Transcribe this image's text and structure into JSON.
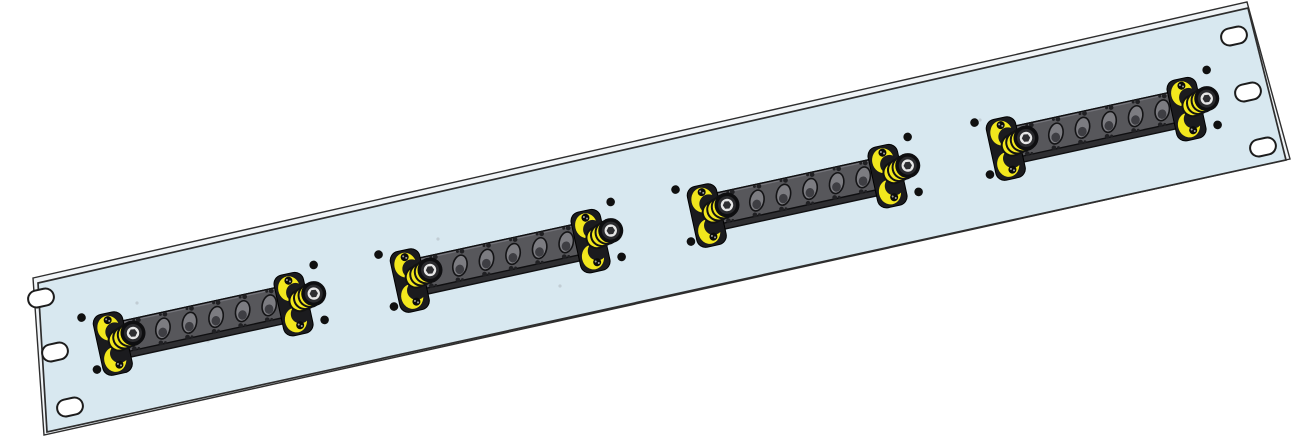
{
  "scene": {
    "width": 1298,
    "height": 441,
    "background": "#ffffff",
    "panel": {
      "description": "1U rack mount patch panel, isometric CAD render, rotated",
      "face_color": "#d8e8f0",
      "edge_color": "#2e2e2e",
      "thickness_color": "#f0f4f7",
      "corners": [
        [
          38,
          283
        ],
        [
          1248,
          8
        ],
        [
          1286,
          160
        ],
        [
          47,
          432
        ]
      ],
      "back_corners": [
        [
          33,
          278
        ],
        [
          1247,
          2
        ],
        [
          1290,
          159
        ],
        [
          44,
          435
        ]
      ]
    },
    "mounting_slots": {
      "fill": "#ffffff",
      "stroke": "#1c1c1c",
      "width": 26,
      "height": 17,
      "rx": 8.5,
      "angle": -12.8,
      "centers": [
        [
          41,
          298
        ],
        [
          55,
          352
        ],
        [
          70,
          407
        ],
        [
          1234,
          36
        ],
        [
          1248,
          92
        ],
        [
          1263,
          147
        ]
      ]
    },
    "modules": {
      "count": 4,
      "angle": -12.3,
      "anchors": [
        [
          133,
          333
        ],
        [
          430,
          270
        ],
        [
          727,
          205
        ],
        [
          1026,
          138
        ]
      ],
      "plate": {
        "x": -20,
        "y": -14,
        "w": 195,
        "h": 31,
        "bevel": 6,
        "face_color": "#57575b",
        "bevel_color": "#2e2e31",
        "stroke": "#0f0f11",
        "top_highlight": "#74747a"
      },
      "ports": {
        "count": 6,
        "start_x": 3,
        "spacing": 27.2,
        "cy": 2,
        "tilt": 24,
        "rx": 7,
        "ry": 10.5,
        "body_color": "#7c7c81",
        "inner_color": "#3e3e43",
        "stroke": "#141416",
        "screw_color": "#202023"
      },
      "holes": {
        "r": 4.3,
        "color": "#101010",
        "offsets": [
          [
            -47,
            -26
          ],
          [
            -43,
            28
          ],
          [
            191,
            -28
          ],
          [
            190,
            28
          ]
        ]
      },
      "fasteners": {
        "positions": [
          [
            0,
            0
          ],
          [
            185,
            0
          ]
        ],
        "bracket": {
          "offset": [
            -22,
            6
          ],
          "w": 30,
          "h": 62,
          "r": 9,
          "color": "#1b1b1e",
          "stroke": "#000000"
        },
        "yellow": "#f2e71d",
        "crescents": [
          {
            "e": [
              -1,
              -16,
              11,
              12.5
            ],
            "c": [
              4.5,
              -11,
              9.5
            ]
          },
          {
            "e": [
              -1,
              16,
              11,
              12.5
            ],
            "c": [
              4.5,
              11,
              9.5
            ]
          }
        ],
        "bracket_screws": {
          "r": 4,
          "color": "#0b0b0b",
          "speck": "#9d9d9d",
          "offsets": [
            [
              0,
              -24
            ],
            [
              2,
              22
            ]
          ]
        },
        "coil": [
          [
            -15,
            4,
            10.5
          ],
          [
            -9.5,
            2.5,
            11
          ],
          [
            -4,
            1,
            11.5
          ]
        ],
        "coil_stroke": "#121212",
        "barrel": {
          "r": 12.5,
          "color": "#0e0e10",
          "ring_r": 6.2,
          "ring_color": "#e6e6e6",
          "hex_r": 4.2,
          "hex_color": "#2e2e31"
        }
      }
    },
    "specks": {
      "color": "#c2cdd4",
      "r": 1.6,
      "points": [
        [
          438,
          239
        ],
        [
          560,
          286
        ],
        [
          137,
          303
        ],
        [
          884,
          150
        ],
        [
          208,
          341
        ],
        [
          980,
          120
        ]
      ]
    }
  }
}
